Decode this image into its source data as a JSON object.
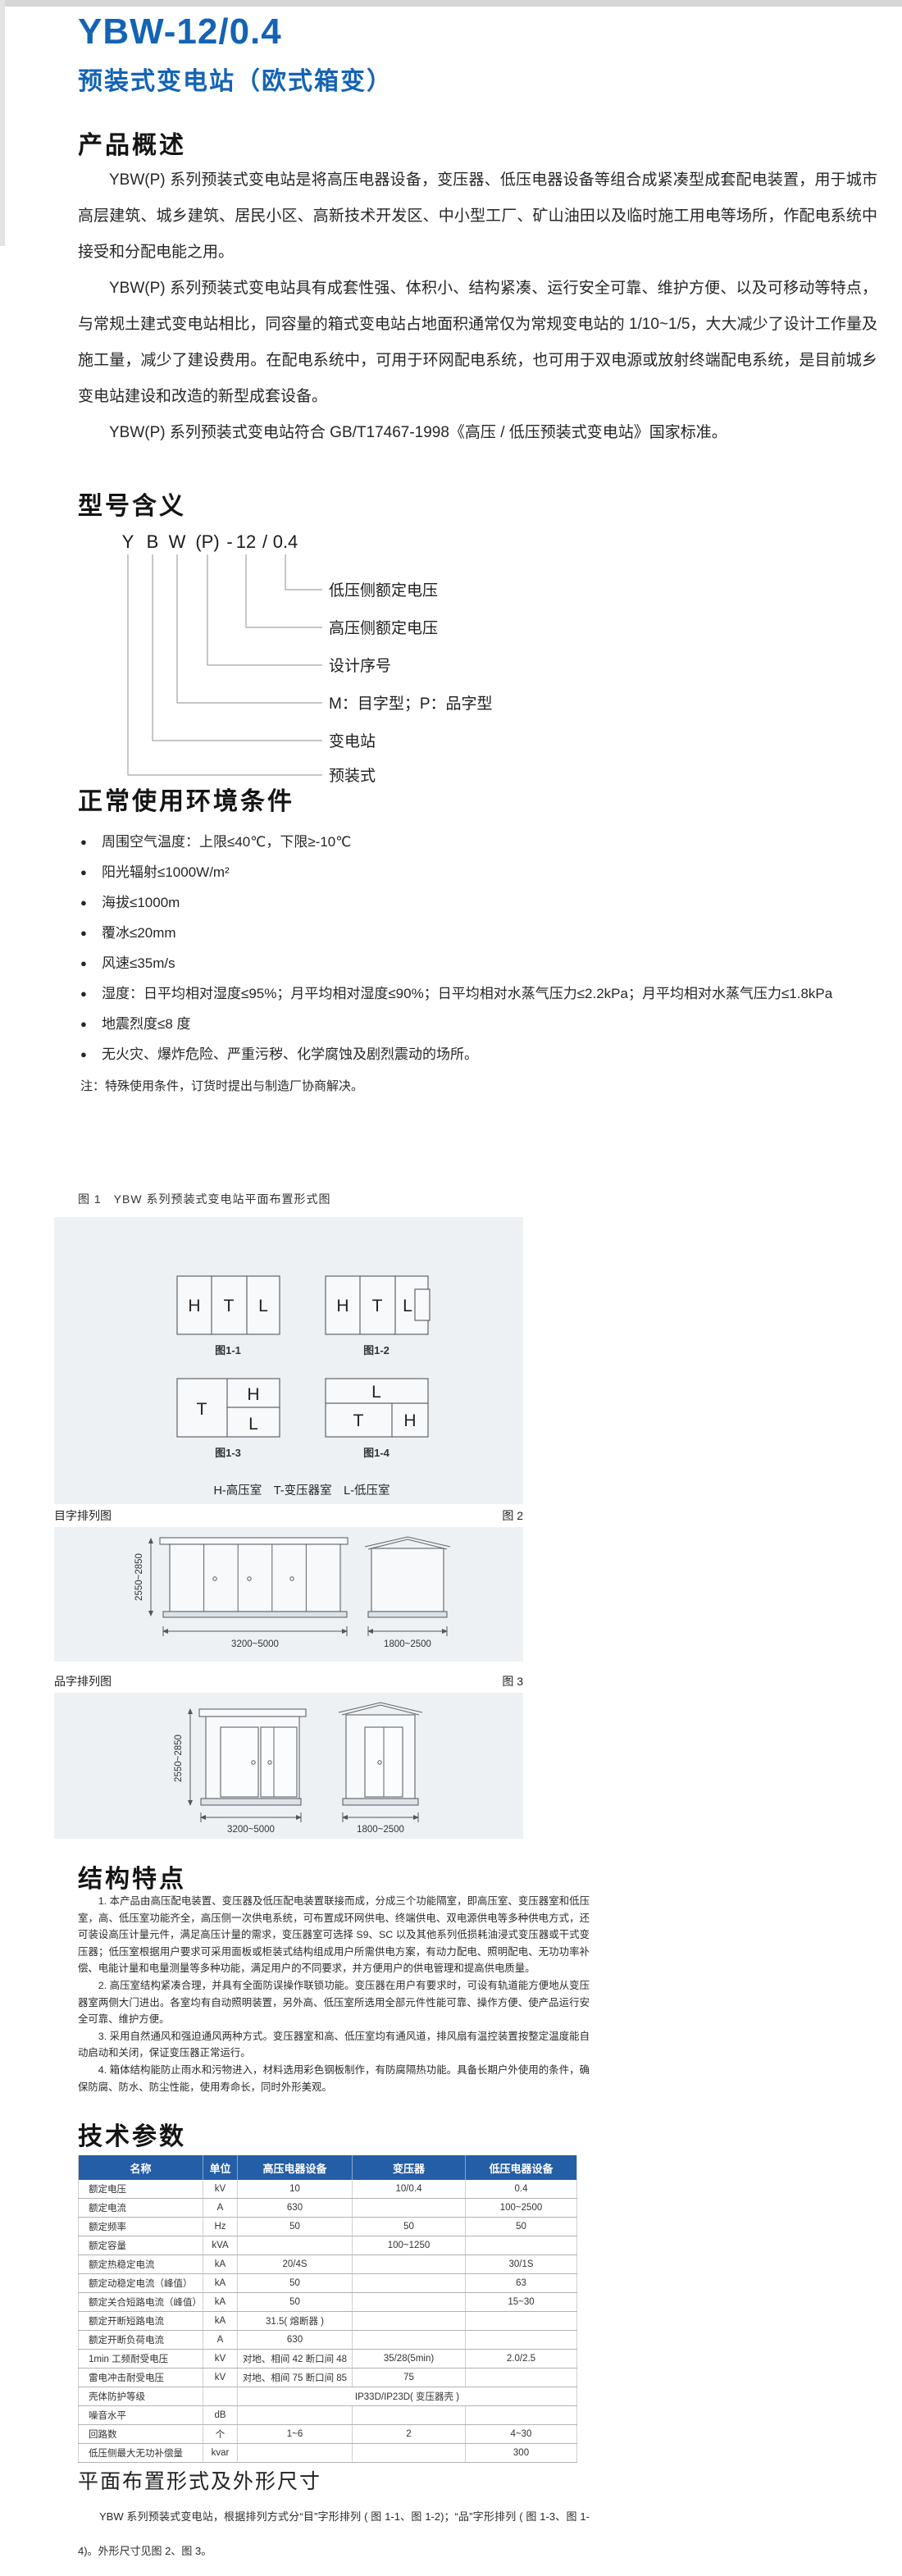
{
  "accent_color": "#1463b4",
  "table_header_color": "#245ea6",
  "panel_bg_color": "#edf1f4",
  "bullet_glyph": "●",
  "page": {
    "title": "YBW-12/0.4",
    "subtitle": "预装式变电站（欧式箱变）"
  },
  "overview": {
    "heading": "产品概述",
    "paragraphs": [
      "YBW(P) 系列预装式变电站是将高压电器设备，变压器、低压电器设备等组合成紧凑型成套配电装置，用于城市高层建筑、城乡建筑、居民小区、高新技术开发区、中小型工厂、矿山油田以及临时施工用电等场所，作配电系统中接受和分配电能之用。",
      "YBW(P) 系列预装式变电站具有成套性强、体积小、结构紧凑、运行安全可靠、维护方便、以及可移动等特点，与常规土建式变电站相比，同容量的箱式变电站占地面积通常仅为常规变电站的 1/10~1/5，大大减少了设计工作量及施工量，减少了建设费用。在配电系统中，可用于环网配电系统，也可用于双电源或放射终端配电系统，是目前城乡变电站建设和改造的新型成套设备。",
      "YBW(P) 系列预装式变电站符合 GB/T17467-1998《高压 / 低压预装式变电站》国家标准。"
    ]
  },
  "model": {
    "heading": "型号含义",
    "code_tokens": [
      "Y",
      "B",
      "W",
      "(P)",
      "-",
      "12",
      "/",
      "0.4"
    ],
    "labels": [
      "低压侧额定电压",
      "高压侧额定电压",
      "设计序号",
      "M：目字型；P：品字型",
      "变电站",
      "预装式"
    ]
  },
  "conditions": {
    "heading": "正常使用环境条件",
    "items": [
      "周围空气温度：上限≤40℃，下限≥-10℃",
      "阳光辐射≤1000W/m²",
      "海拔≤1000m",
      "覆冰≤20mm",
      "风速≤35m/s",
      "湿度：日平均相对湿度≤95%；月平均相对湿度≤90%；日平均相对水蒸气压力≤2.2kPa；月平均相对水蒸气压力≤1.8kPa",
      "地震烈度≤8 度",
      "无火灾、爆炸危险、严重污秽、化学腐蚀及剧烈震动的场所。"
    ],
    "note": "注：特殊使用条件，订货时提出与制造厂协商解决。"
  },
  "figure1": {
    "caption": "图 1　YBW 系列预装式变电站平面布置形式图",
    "rooms": {
      "h": "H",
      "t": "T",
      "l": "L"
    },
    "sub_captions": [
      "图1-1",
      "图1-2",
      "图1-3",
      "图1-4"
    ],
    "legend": "H-高压室　T-变压器室　L-低压室"
  },
  "figure2": {
    "label_left": "目字排列图",
    "label_right": "图 2",
    "dim_height": "2550~2850",
    "dim_front_width": "3200~5000",
    "dim_side_width": "1800~2500"
  },
  "figure3": {
    "label_left": "品字排列图",
    "label_right": "图 3",
    "dim_height": "2550~2850",
    "dim_front_width": "3200~5000",
    "dim_side_width": "1800~2500"
  },
  "structure": {
    "heading": "结构特点",
    "paragraphs": [
      "1. 本产品由高压配电装置、变压器及低压配电装置联接而成，分成三个功能隔室，即高压室、变压器室和低压室，高、低压室功能齐全，高压侧一次供电系统，可布置成环网供电、终端供电、双电源供电等多种供电方式，还可装设高压计量元件，满足高压计量的需求，变压器室可选择 S9、SC 以及其他系列低损耗油浸式变压器或干式变压器；低压室根据用户要求可采用面板或柜装式结构组成用户所需供电方案，有动力配电、照明配电、无功功率补偿、电能计量和电量测量等多种功能，满足用户的不同要求，并方便用户的供电管理和提高供电质量。",
      "2. 高压室结构紧凑合理，并具有全面防误操作联锁功能。变压器在用户有要求时，可设有轨道能方便地从变压器室两侧大门进出。各室均有自动照明装置，另外高、低压室所选用全部元件性能可靠、操作方便、使产品运行安全可靠、维护方便。",
      "3. 采用自然通风和强迫通风两种方式。变压器室和高、低压室均有通风道，排风扇有温控装置按整定温度能自动启动和关闭，保证变压器正常运行。",
      "4. 箱体结构能防止雨水和污物进入，材料选用彩色钢板制作，有防腐隔热功能。具备长期户外使用的条件，确保防腐、防水、防尘性能，使用寿命长，同时外形美观。"
    ]
  },
  "tech_table": {
    "heading": "技术参数",
    "headers": [
      "名称",
      "单位",
      "高压电器设备",
      "变压器",
      "低压电器设备"
    ],
    "rows": [
      {
        "cells": [
          "额定电压",
          "kV",
          "10",
          "10/0.4",
          "0.4"
        ]
      },
      {
        "cells": [
          "额定电流",
          "A",
          "630",
          "",
          "100~2500"
        ]
      },
      {
        "cells": [
          "额定频率",
          "Hz",
          "50",
          "50",
          "50"
        ]
      },
      {
        "cells": [
          "额定容量",
          "kVA",
          "",
          "100~1250",
          ""
        ]
      },
      {
        "cells": [
          "额定热稳定电流",
          "kA",
          "20/4S",
          "",
          "30/1S"
        ]
      },
      {
        "cells": [
          "额定动稳定电流（峰值）",
          "kA",
          "50",
          "",
          "63"
        ]
      },
      {
        "cells": [
          "额定关合短路电流（峰值）",
          "kA",
          "50",
          "",
          "15~30"
        ]
      },
      {
        "cells": [
          "额定开断短路电流",
          "kA",
          "31.5( 熔断器 )",
          "",
          ""
        ]
      },
      {
        "cells": [
          "额定开断负荷电流",
          "A",
          "630",
          "",
          ""
        ]
      },
      {
        "cells": [
          "1min 工频耐受电压",
          "kV",
          "对地、相间 42 断口间 48",
          "35/28(5min)",
          "2.0/2.5"
        ]
      },
      {
        "cells": [
          "雷电冲击耐受电压",
          "kV",
          "对地、相间 75 断口间 85",
          "75",
          ""
        ]
      },
      {
        "cells": [
          "壳体防护等级",
          "",
          "IP33D/IP23D( 变压器壳 )"
        ],
        "span_last": 3
      },
      {
        "cells": [
          "噪音水平",
          "dB",
          "",
          "",
          ""
        ]
      },
      {
        "cells": [
          "回路数",
          "个",
          "1~6",
          "2",
          "4~30"
        ]
      },
      {
        "cells": [
          "低压侧最大无功补偿量",
          "kvar",
          "",
          "",
          "300"
        ]
      }
    ]
  },
  "layout_section": {
    "heading": "平面布置形式及外形尺寸",
    "paragraph": "YBW 系列预装式变电站，根据排列方式分“目”字形排列 ( 图 1-1、图 1-2)；“品”字形排列 ( 图 1-3、图 1-4)。外形尺寸见图 2、图 3。"
  }
}
